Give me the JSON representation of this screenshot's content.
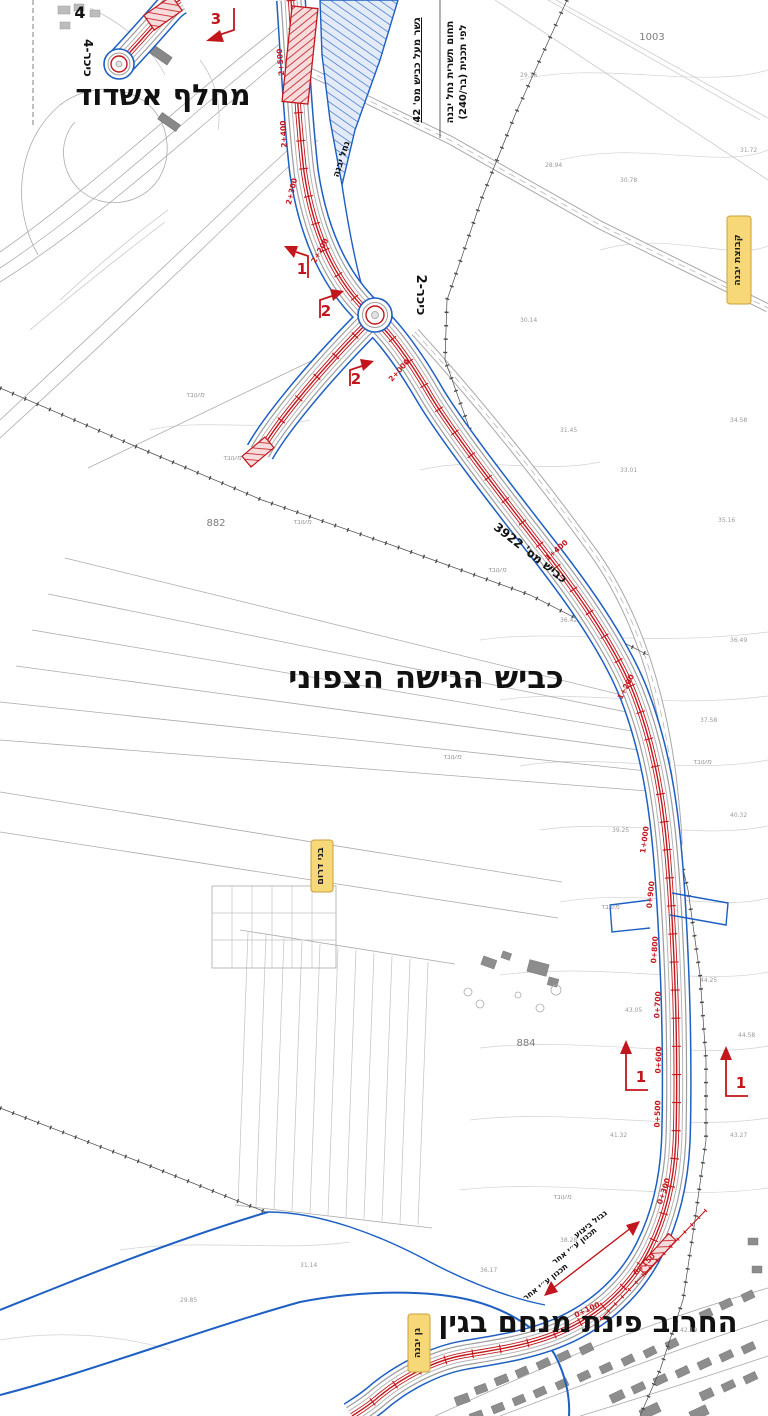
{
  "labels": {
    "interchange": "מחלף אשדוד",
    "access_road": "כביש הגישה הצפוני",
    "street_corner": "החרוב פינת מנחם בגין",
    "roundabout_4": "כיכר-4",
    "roundabout_2": "כיכר-2",
    "road_3922": "כביש מס' 3922",
    "nahal_yavne": "נחל יבנה",
    "bridge_note": "גשר מעל כביש מס' 42",
    "stream_zone_1": "תחום תשרית נחל יבנה",
    "stream_zone_2": "לפי תכנית (בר/240)",
    "exec_boundary": "גבול ביצוע",
    "design_by_other_1": "תכנון ע״י אחר",
    "design_by_other_2": "תכנון ע״י אחר",
    "corner_marker": "4",
    "landuse_word": "מעובד"
  },
  "yellow_labels": [
    {
      "text": "קבוצת יבנה"
    },
    {
      "text": "בני דרום"
    },
    {
      "text": "גן יבנה"
    }
  ],
  "parcels": [
    {
      "num": "1003"
    },
    {
      "num": "882"
    },
    {
      "num": "884"
    }
  ],
  "section_markers": [
    {
      "num": "3"
    },
    {
      "num": "1"
    },
    {
      "num": "2"
    },
    {
      "num": "2"
    },
    {
      "num": "1"
    },
    {
      "num": "1"
    }
  ],
  "chainages": [
    {
      "v": "2+500"
    },
    {
      "v": "2+400"
    },
    {
      "v": "2+300"
    },
    {
      "v": "2+200"
    },
    {
      "v": "2+000"
    },
    {
      "v": "1+400"
    },
    {
      "v": "1+200"
    },
    {
      "v": "1+000"
    },
    {
      "v": "0+900"
    },
    {
      "v": "0+800"
    },
    {
      "v": "0+700"
    },
    {
      "v": "0+600"
    },
    {
      "v": "0+500"
    },
    {
      "v": "0+300"
    },
    {
      "v": "0+150"
    },
    {
      "v": "0+100"
    }
  ],
  "spot_elevations": [
    {
      "v": "29.16"
    },
    {
      "v": "28.94"
    },
    {
      "v": "30.78"
    },
    {
      "v": "31.72"
    },
    {
      "v": "30.14"
    },
    {
      "v": "31.45"
    },
    {
      "v": "33.01"
    },
    {
      "v": "34.58"
    },
    {
      "v": "35.16"
    },
    {
      "v": "36.42"
    },
    {
      "v": "36.49"
    },
    {
      "v": "37.58"
    },
    {
      "v": "40.32"
    },
    {
      "v": "39.25"
    },
    {
      "v": "44.25"
    },
    {
      "v": "43.05"
    },
    {
      "v": "44.58"
    },
    {
      "v": "41.32"
    },
    {
      "v": "43.27"
    },
    {
      "v": "38.28"
    },
    {
      "v": "36.17"
    },
    {
      "v": "31.14"
    },
    {
      "v": "29.85"
    },
    {
      "v": "42.19"
    }
  ],
  "colors": {
    "alignment_red": "#c3161c",
    "row_blue": "#1d5fc2",
    "yellow_badge": "#f7d878",
    "survey_gray": "#9c9c9c"
  }
}
